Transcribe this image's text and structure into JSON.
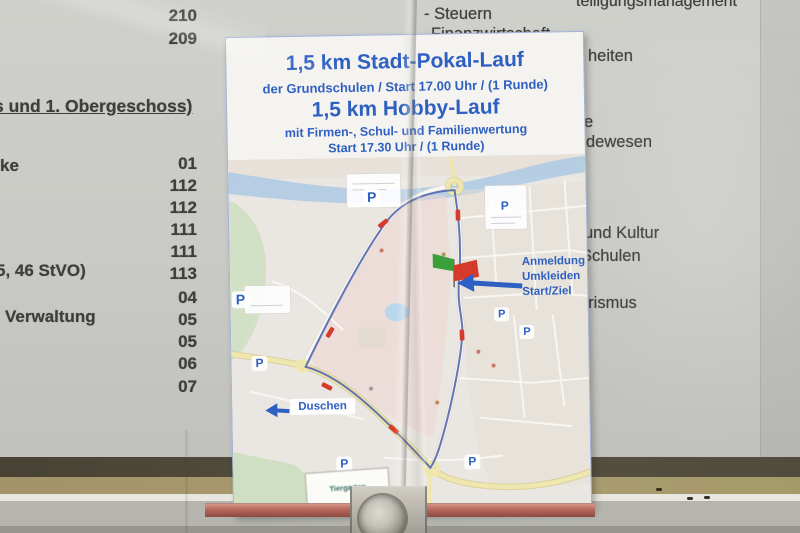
{
  "directory": {
    "heading": "s und 1. Obergeschoss)",
    "top_numbers": [
      "211",
      "210",
      "209"
    ],
    "room_numbers": [
      "01",
      "112",
      "112",
      "111",
      "111",
      "113",
      "04",
      "05",
      "05",
      "06",
      "07"
    ],
    "left_items": [
      "ke",
      "5, 46 StVO)",
      "Verwaltung"
    ],
    "right_items": [
      "teiligungsmanagement",
      "- Steuern",
      "Finanzwirtschaft",
      "heiten",
      "e",
      "dewesen",
      "und Kultur",
      "Schulen",
      "urismus"
    ]
  },
  "flyer": {
    "title_1": "1,5 km Stadt-Pokal-Lauf",
    "subtitle_1": "der Grundschulen / Start 17.00 Uhr / (1 Runde)",
    "title_2": "1,5 km Hobby-Lauf",
    "subtitle_2": "mit Firmen-, Schul- und Familienwertung",
    "subtitle_3": "Start 17.30 Uhr / (1 Runde)",
    "map": {
      "registration_label_lines": [
        "Anmeldung",
        "Umkleiden",
        "Start/Ziel"
      ],
      "showers_label": "Duschen",
      "area_label": "Tiergarten",
      "parking_symbol": "P"
    }
  },
  "colors": {
    "flyer_blue": "#2e5fc2",
    "route_blue": "#5b6db0",
    "marker_red": "#d63a2a",
    "water": "#a9c8e4",
    "road_yellow": "#f0e7ae",
    "park_green": "#cfe0c2",
    "zone_pink": "#edd6d4",
    "paper_gray": "#cbccc7",
    "ink_dark": "#3e3e3a"
  }
}
